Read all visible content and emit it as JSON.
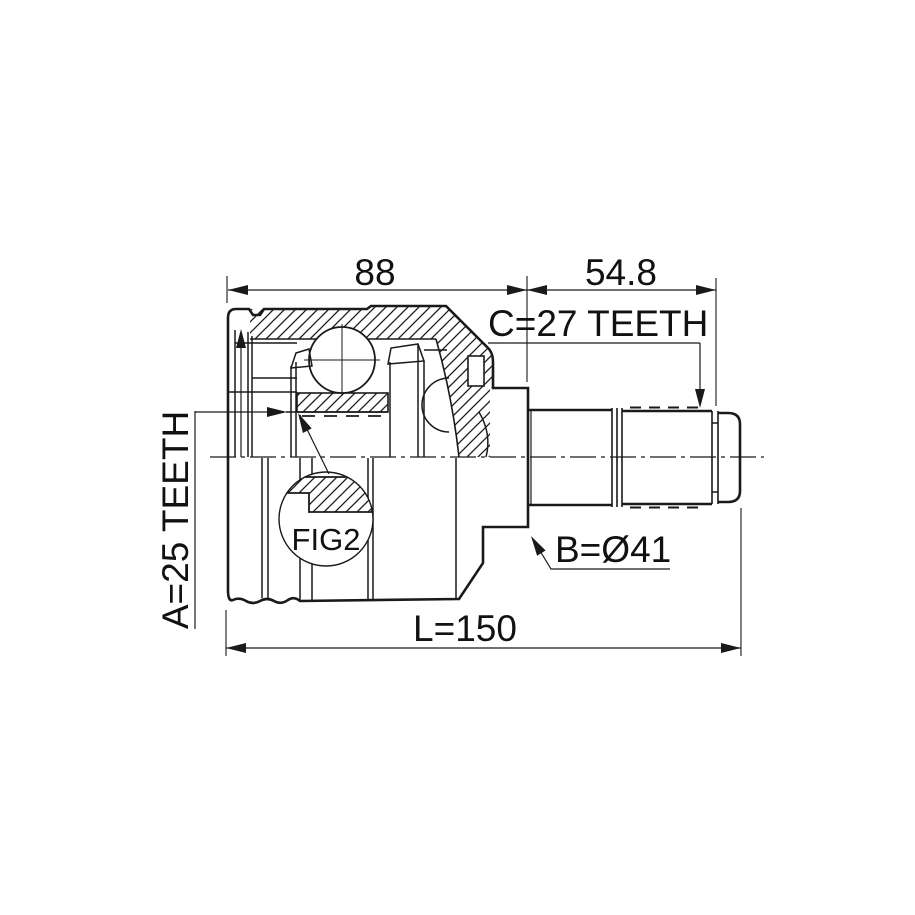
{
  "page": {
    "background": "#ffffff",
    "line_color": "#1a1a1a"
  },
  "drawing": {
    "kind": "technical-drawing",
    "subject": "CV joint (constant velocity joint) cross-section with dimensions",
    "dimensions": {
      "housing_width": "88",
      "spline_length": "54.8",
      "overall_length": "L=150",
      "outer_spline_teeth": "C=27 TEETH",
      "inner_spline_teeth": "A=25 TEETH",
      "shaft_diameter": "B=Ø41",
      "detail_callout": "FIG2"
    }
  }
}
